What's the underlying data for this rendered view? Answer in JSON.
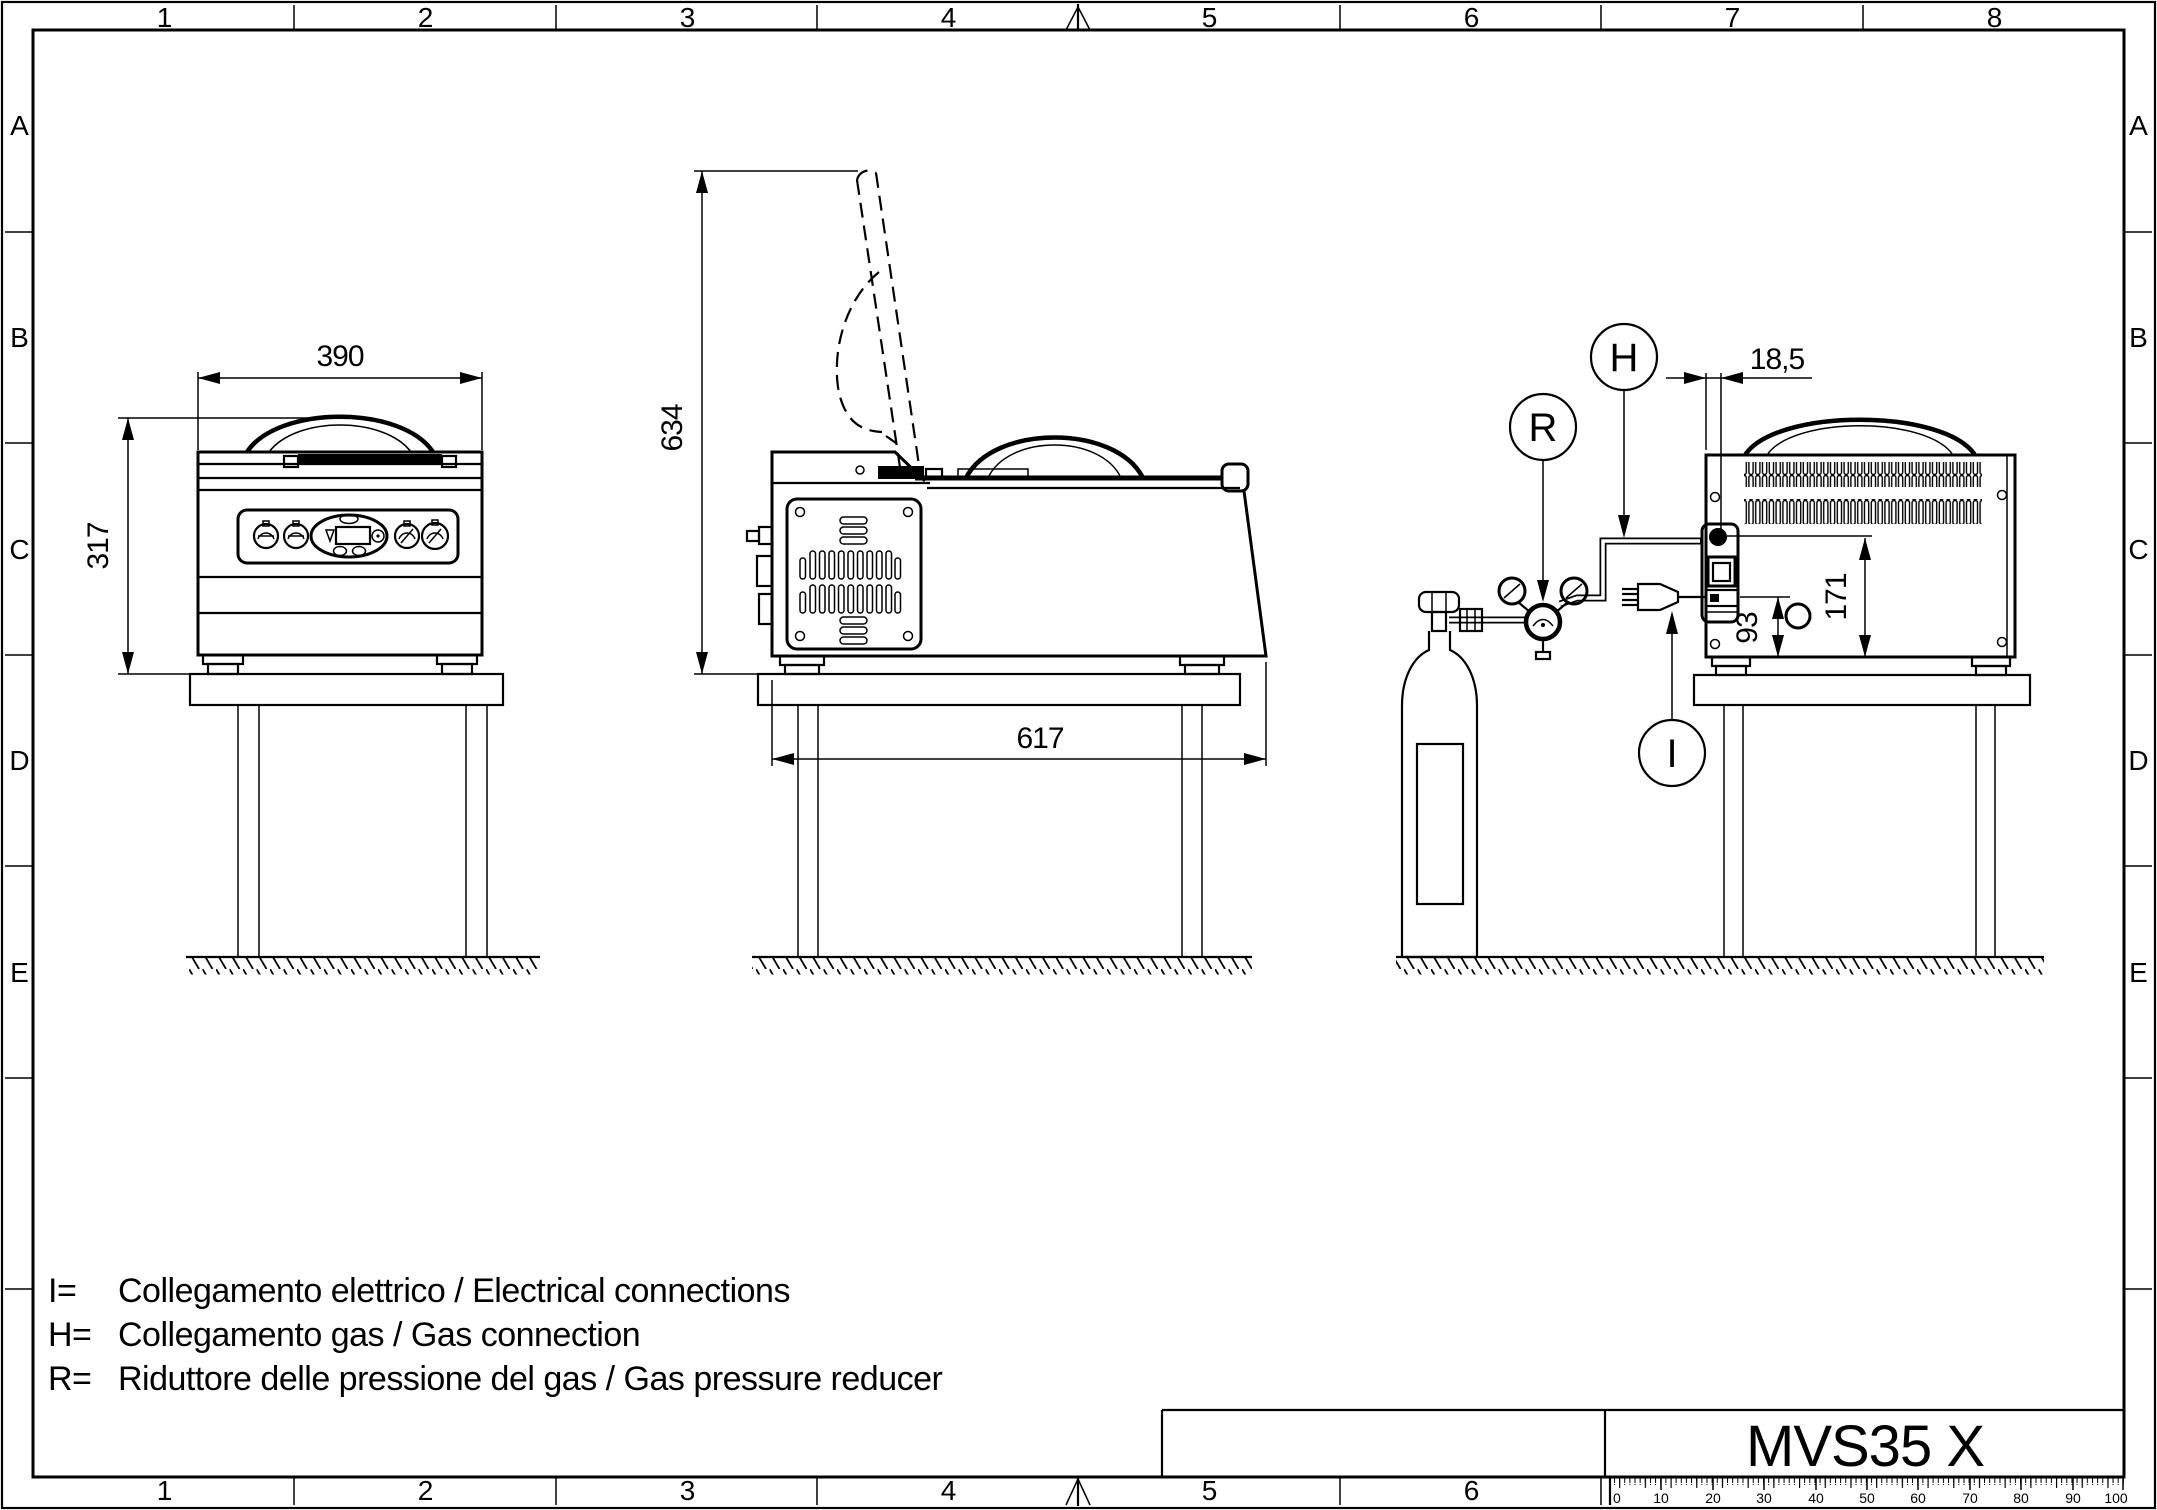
{
  "sheet": {
    "zones_top": [
      "1",
      "2",
      "3",
      "4",
      "5",
      "6",
      "7",
      "8"
    ],
    "zones_bottom": [
      "1",
      "2",
      "3",
      "4",
      "5",
      "6"
    ],
    "rows": [
      "A",
      "B",
      "C",
      "D",
      "E"
    ],
    "ruler_labels": [
      "0",
      "10",
      "20",
      "30",
      "40",
      "50",
      "60",
      "70",
      "80",
      "90",
      "100"
    ]
  },
  "title_block": {
    "model": "MVS35 X"
  },
  "dimensions": {
    "front_width": "390",
    "front_height": "317",
    "open_lid_height": "634",
    "depth": "617",
    "gas_offset": "18,5",
    "gas_height": "171",
    "plug_height": "93"
  },
  "balloons": {
    "gas": "H",
    "reducer": "R",
    "electric": "I"
  },
  "legend": {
    "line1_prefix": "I=",
    "line1_text": "Collegamento elettrico / Electrical connections",
    "line2_prefix": "H=",
    "line2_text": "Collegamento gas / Gas connection",
    "line3_prefix": "R=",
    "line3_text": "Riduttore delle pressione del gas / Gas pressure reducer"
  },
  "colors": {
    "line": "#000000",
    "background": "#ffffff"
  }
}
